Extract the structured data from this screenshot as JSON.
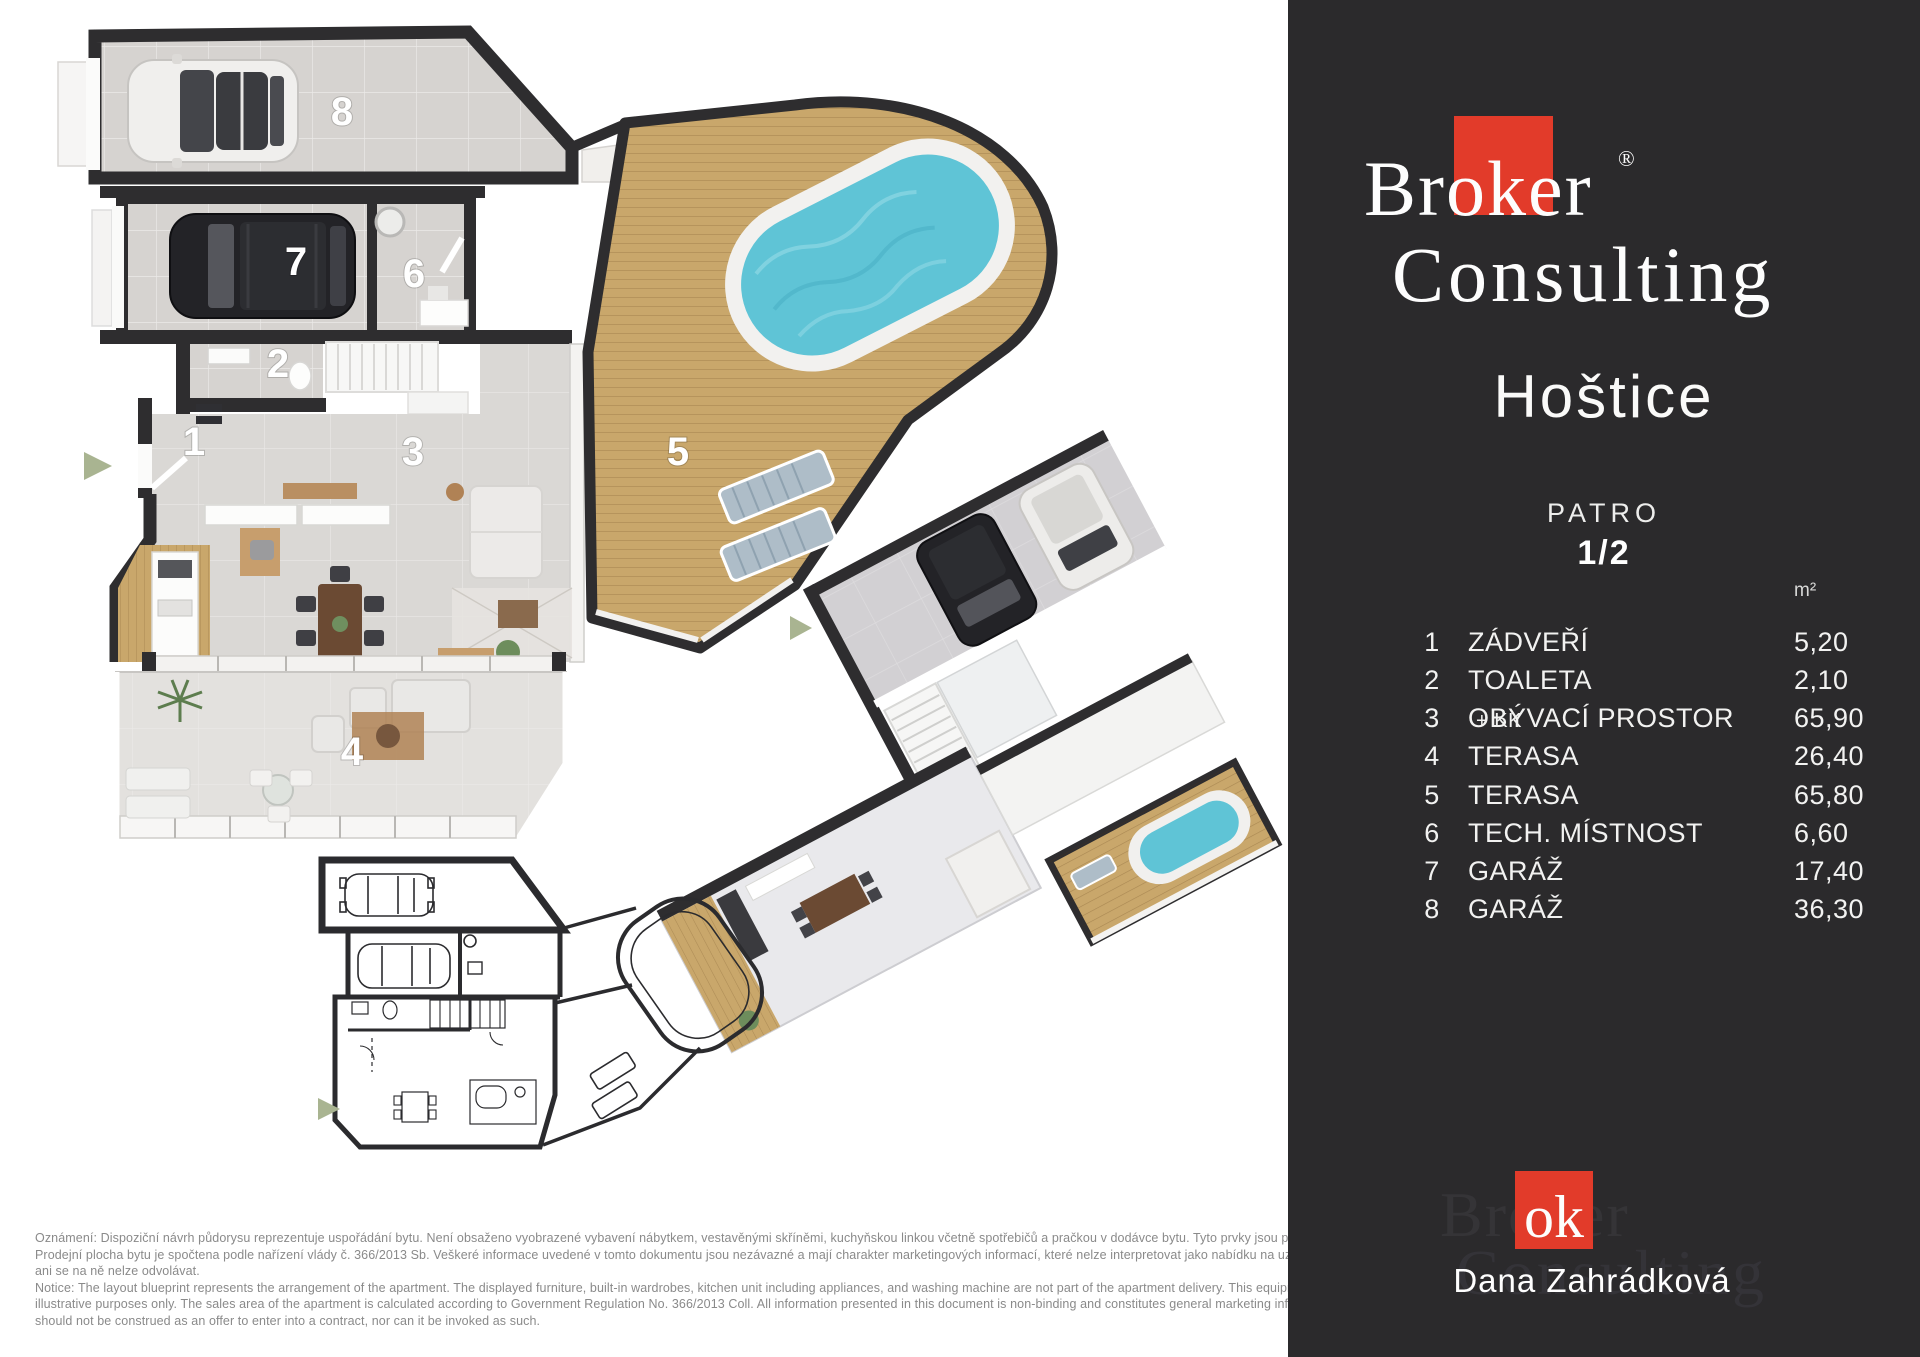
{
  "brand": {
    "name_top": "Broker",
    "name_bottom": "Consulting",
    "reg": "®",
    "ok": "ok"
  },
  "panel": {
    "title": "Hoštice",
    "floor_label": "PATRO",
    "floor_value": "1/2",
    "unit": "m²",
    "agent": "Dana Zahrádková",
    "watermark_line1": "Broker",
    "watermark_line2": "Consulting"
  },
  "rooms": [
    {
      "num": "1",
      "name": "ZÁDVEŘÍ",
      "suffix": "",
      "area": "5,20"
    },
    {
      "num": "2",
      "name": "TOALETA",
      "suffix": "",
      "area": "2,10"
    },
    {
      "num": "3",
      "name": "OBÝVACÍ PROSTOR",
      "suffix": "+ KK",
      "area": "65,90"
    },
    {
      "num": "4",
      "name": "TERASA",
      "suffix": "",
      "area": "26,40"
    },
    {
      "num": "5",
      "name": "TERASA",
      "suffix": "",
      "area": "65,80"
    },
    {
      "num": "6",
      "name": "TECH. MÍSTNOST",
      "suffix": "",
      "area": "6,60"
    },
    {
      "num": "7",
      "name": "GARÁŽ",
      "suffix": "",
      "area": "17,40"
    },
    {
      "num": "8",
      "name": "GARÁŽ",
      "suffix": "",
      "area": "36,30"
    }
  ],
  "plan_labels": {
    "l1": "1",
    "l2": "2",
    "l3": "3",
    "l4": "4",
    "l5": "5",
    "l6": "6",
    "l7": "7",
    "l8": "8"
  },
  "disclaimer": {
    "lines": [
      "Oznámení: Dispoziční návrh půdorysu reprezentuje uspořádání bytu. Není obsaženo vyobrazené vybavení nábytkem, vestavěnými skříněmi, kuchyňskou linkou včetně spotřebičů a pračkou v dodávce bytu. Tyto prvky jsou pouze ilustrační.",
      "Prodejní plocha bytu je spočtena podle nařízení vlády č. 366/2013 Sb. Veškeré informace uvedené v tomto dokumentu jsou nezávazné a mají charakter marketingových informací, které nelze interpretovat jako nabídku na uzavření smlouvy,",
      "ani se na ně nelze odvolávat.",
      "Notice: The layout blueprint represents the arrangement of the apartment. The displayed furniture, built-in wardrobes, kitchen unit including appliances, and washing machine are not part of the apartment delivery. This equipment is shown for",
      "illustrative purposes only. The sales area of the apartment is calculated according to Government Regulation No. 366/2013 Coll. All information presented in this document is non-binding and constitutes general marketing information, which",
      "should not be construed as an offer to enter into a contract, nor can it be invoked as such."
    ]
  },
  "colors": {
    "red": "#e23b2a",
    "wall": "#2e2d2f",
    "wood": "#c9a76b",
    "pool": "#5fc4d6",
    "panelbg": "#2b2a2c",
    "sage": "#a9b491"
  }
}
